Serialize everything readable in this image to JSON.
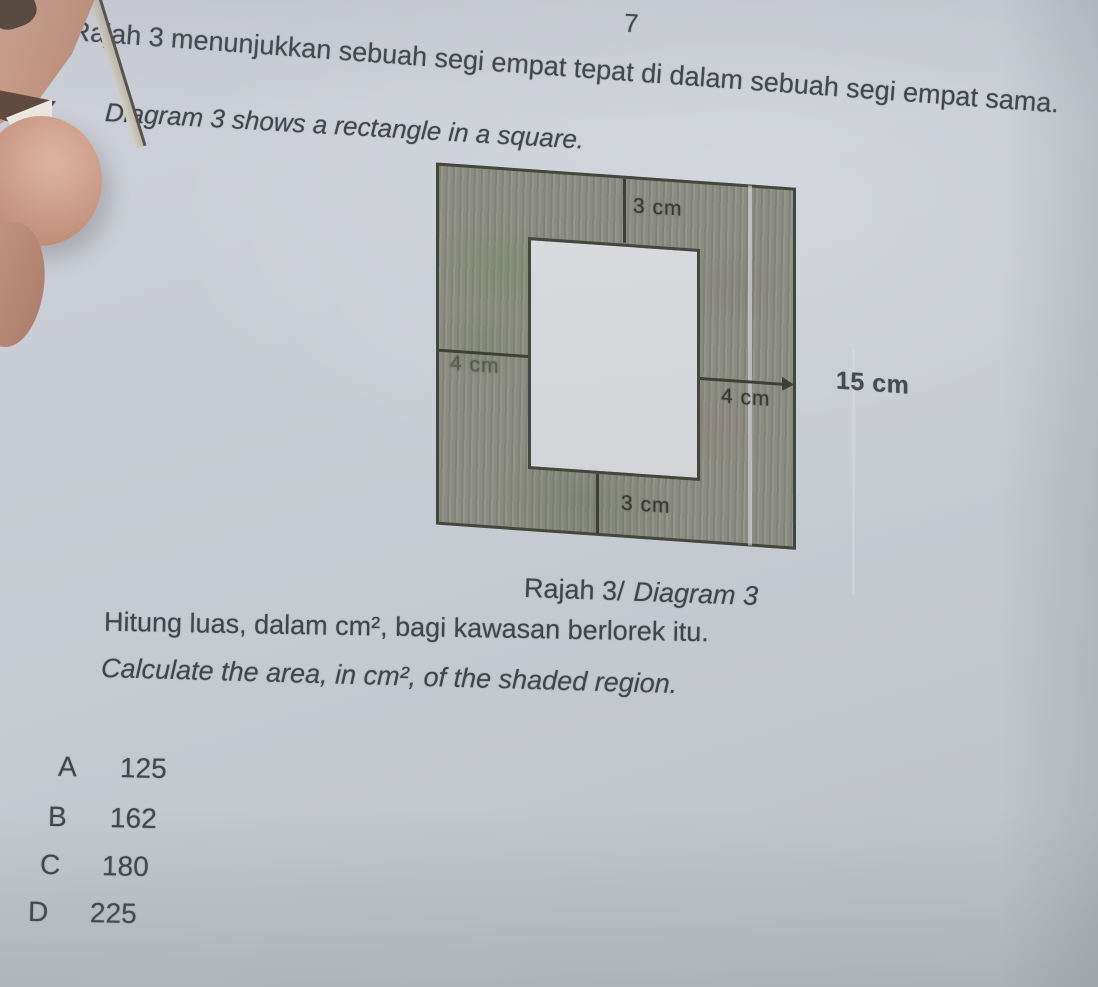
{
  "page_number": "7",
  "question": {
    "malay": "Rajah 3 menunjukkan sebuah segi empat tepat di dalam sebuah segi empat sama.",
    "english": "Diagram 3 shows a rectangle in a square."
  },
  "diagram": {
    "caption_malay": "Rajah 3/",
    "caption_english": "Diagram 3",
    "labels": {
      "top_margin": "3 cm",
      "left_margin": "4 cm",
      "right_margin": "4 cm",
      "bottom_margin": "3 cm",
      "outer_side": "15 cm"
    },
    "colors": {
      "shaded_fill": "#8f9086",
      "outline": "#45463d",
      "inner_fill": "#d5d7db",
      "paper": "#c7cad2"
    }
  },
  "task": {
    "malay": "Hitung luas, dalam cm², bagi kawasan berlorek itu.",
    "english": "Calculate the area, in cm², of the shaded region."
  },
  "options": [
    {
      "letter": "A",
      "value": "125"
    },
    {
      "letter": "B",
      "value": "162"
    },
    {
      "letter": "C",
      "value": "180"
    },
    {
      "letter": "D",
      "value": "225"
    }
  ]
}
